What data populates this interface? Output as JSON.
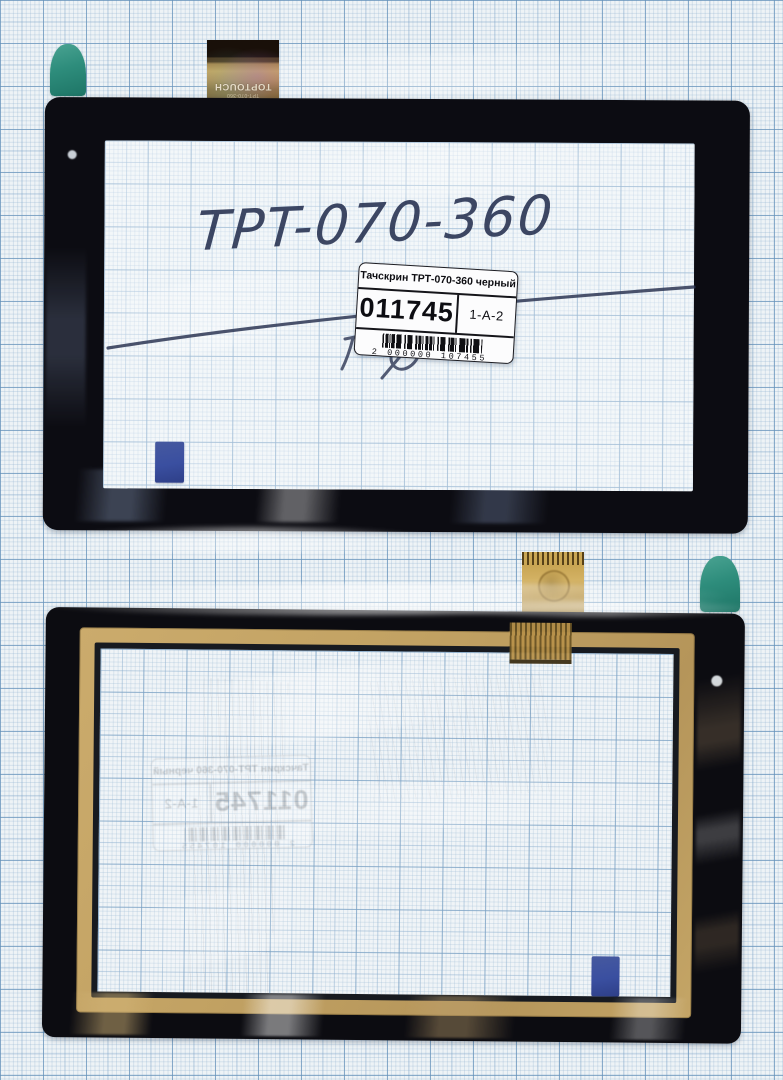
{
  "product_label": {
    "title": "Тачскрин ТРТ-070-360 черный",
    "code": "011745",
    "slot": "1-A-2",
    "barcode_digits": "2 000000 107455"
  },
  "handwriting": {
    "model": "TPT-070-360"
  },
  "flex_cable": {
    "brand": "TOPTOUCH",
    "model": "TPT-070-360"
  },
  "colors": {
    "paper": "#eef3f6",
    "grid_major": "#6491b9",
    "panel_black": "#0c0c12",
    "gold_frame": "#c2a263",
    "teal_sticker": "#2e8d7c",
    "blue_sticker": "#3a4fa0",
    "ink": "#2a3453",
    "flex_gold": "#c8a452",
    "label_bg": "#fcfcfd"
  }
}
